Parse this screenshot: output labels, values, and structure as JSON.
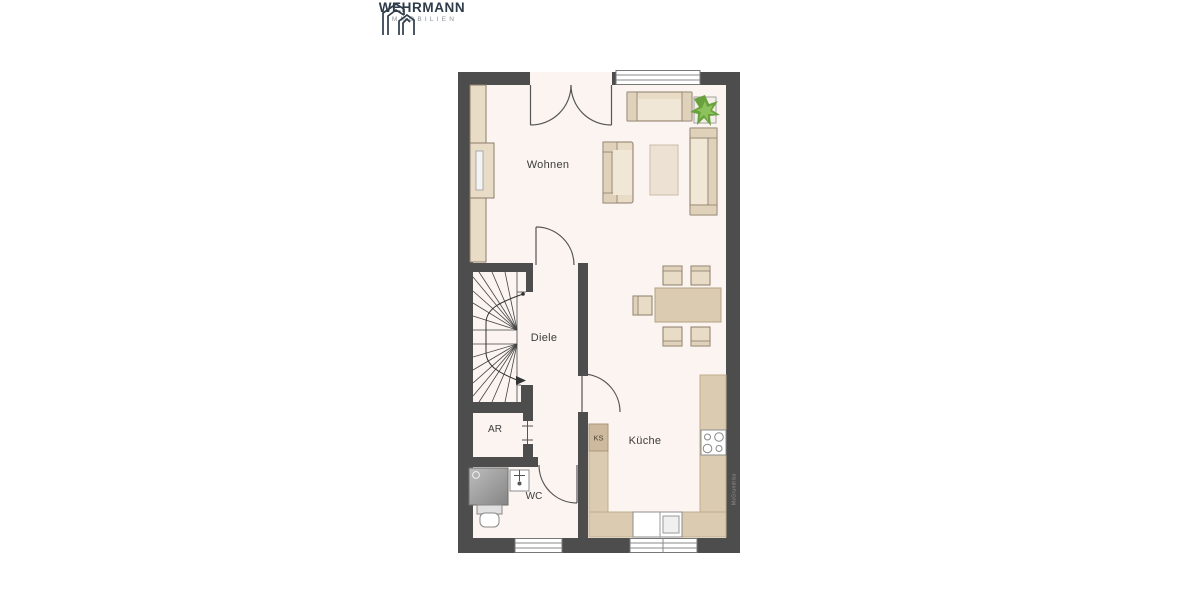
{
  "logo": {
    "title": "WEHRMANN",
    "subtitle": "IMMOBILIEN"
  },
  "rooms": {
    "living": "Wohnen",
    "hall": "Diele",
    "storage": "AR",
    "wc": "WC",
    "kitchen": "Küche",
    "fridge": "KS"
  },
  "watermark": "McGrundriss",
  "colors": {
    "wall": "#4d4d4d",
    "floor": "#fbf4f0",
    "furniture": "#e9dcc6",
    "furniture-border": "#8a7d69",
    "furniture-light": "#f0e7d6",
    "counter": "#dbcbb0",
    "counter-border": "#bfae90",
    "ks": "#cdb99d",
    "logo-navy": "#2e3b49",
    "logo-gray": "#8a8f98",
    "plant-green": "#69a13d",
    "label": "#3c3c3c"
  }
}
